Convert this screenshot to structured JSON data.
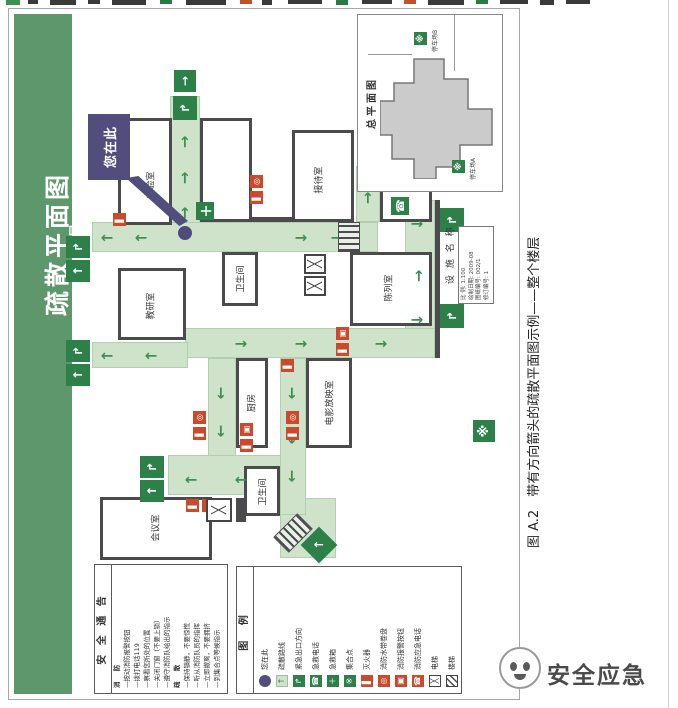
{
  "banner": {
    "title": "疏散平面图",
    "floor": "1层"
  },
  "you_are_here": {
    "label": "您在此"
  },
  "rooms": {
    "lab": "实验室",
    "reception": "接待室",
    "exhibition": "陈列室",
    "toilet1": "卫生间",
    "research": "教研室",
    "cinema": "电影放映室",
    "kitchen": "厨房",
    "toilet2": "卫生间",
    "meeting": "会议室"
  },
  "safety_notice": {
    "title": "安 全 通 告",
    "lines": [
      "消  防",
      "—按动消防报警按钮",
      "—拨打电话119",
      "—察看您所处的位置",
      "—关闭门窗（不要上锁）",
      "—遵守消防队给出的指示",
      "疏  散",
      "—保持镇静，不要惊慌",
      "—听从消防队员的指挥",
      "—立即撤离，不要拥挤",
      "—到集合点等候指示"
    ]
  },
  "legend": {
    "title": "图 例",
    "items": [
      {
        "label": "您在此",
        "icon": "you-are-here-dot"
      },
      {
        "label": "疏散路线",
        "icon": "evacuation-route-arrow"
      },
      {
        "label": "紧急出口方向",
        "icon": "emergency-exit-sign"
      },
      {
        "label": "急救电话",
        "icon": "first-aid-phone"
      },
      {
        "label": "急救箱",
        "icon": "first-aid-kit"
      },
      {
        "label": "集合点",
        "icon": "assembly-point"
      },
      {
        "label": "灭火器",
        "icon": "fire-extinguisher"
      },
      {
        "label": "消防水带卷盘",
        "icon": "fire-hose-reel"
      },
      {
        "label": "消防报警按钮",
        "icon": "fire-alarm-button"
      },
      {
        "label": "消防应急电话",
        "icon": "fire-emergency-phone"
      },
      {
        "label": "电梯",
        "icon": "elevator"
      },
      {
        "label": "楼梯",
        "icon": "stairs"
      }
    ]
  },
  "overview": {
    "title": "总平面图",
    "parking_a": "停车场A",
    "parking_b": "停车场B"
  },
  "facility": {
    "label": "设 施 名 称",
    "info_lines": [
      "比 例: 1:100",
      "绘制日期: 2009-08",
      "图纸编号: 002/1",
      "修订编号: 1"
    ]
  },
  "caption": {
    "text": "图 A.2　带有方向箭头的疏散平面图示例——整个楼层"
  },
  "watermark": {
    "text": "安全应急"
  }
}
